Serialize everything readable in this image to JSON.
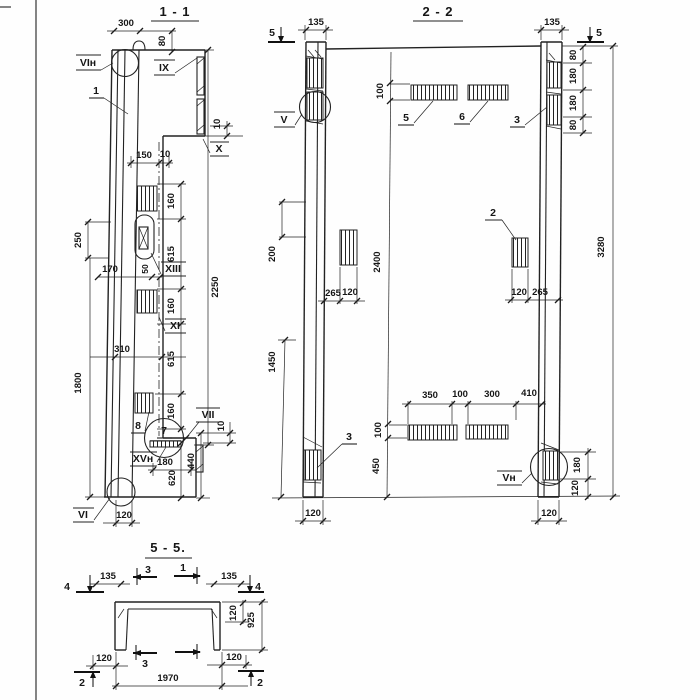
{
  "s11": {
    "title": "1 - 1",
    "node_vin": "VIн",
    "callout_1": "1",
    "node_ix": "IX",
    "node_x": "X",
    "node_xiii": "XIII",
    "node_xi": "XI",
    "node_vii": "VII",
    "node_xvn": "XVн",
    "node_vi": "VI",
    "detail_7": "7",
    "callout_8": "8",
    "d300": "300",
    "d80": "80",
    "d150": "150",
    "d10": "10",
    "d250": "250",
    "d170": "170",
    "d50": "50",
    "d160": "160",
    "d615": "615",
    "d2250": "2250",
    "d310": "310",
    "d1800": "1800",
    "d180": "180",
    "d620": "620",
    "d440": "440",
    "d120": "120"
  },
  "s22": {
    "title": "2 - 2",
    "cut_5": "5",
    "node_v": "V",
    "node_vn": "Vн",
    "callout_2": "2",
    "callout_3": "3",
    "callout_5": "5",
    "callout_6": "6",
    "d135": "135",
    "d80": "80",
    "d180": "180",
    "d100": "100",
    "d200": "200",
    "d265": "265",
    "d120": "120",
    "d2400": "2400",
    "d3280": "3280",
    "d1450": "1450",
    "d450": "450",
    "d350": "350",
    "d300": "300",
    "d410": "410"
  },
  "s55": {
    "title": "5 - 5.",
    "cut_1": "1",
    "cut_2": "2",
    "cut_3": "3",
    "cut_4": "4",
    "d135": "135",
    "d120": "120",
    "d925": "925",
    "d1970": "1970"
  }
}
